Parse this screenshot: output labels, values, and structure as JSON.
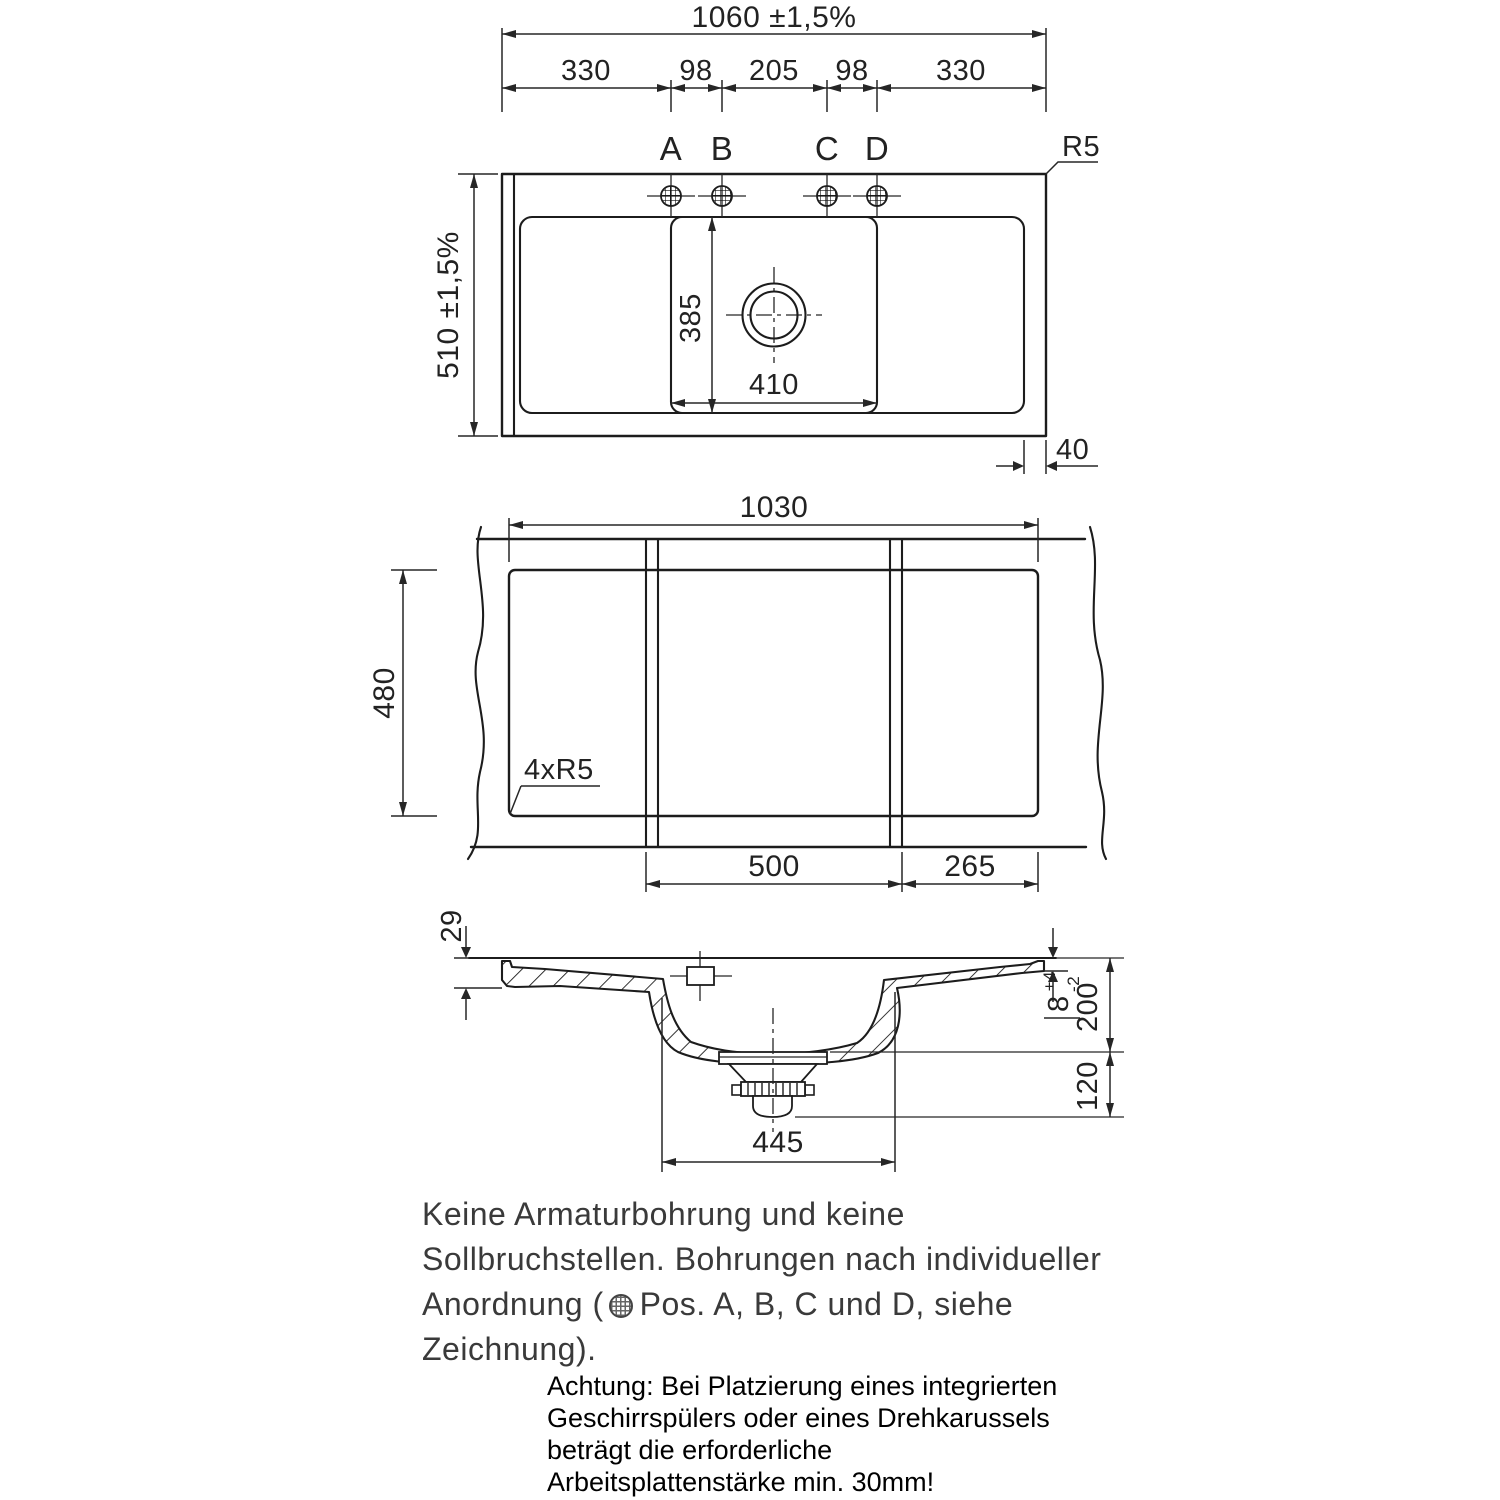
{
  "top_view": {
    "dim_overall_width": "1060 ±1,5%",
    "dim_overall_depth": "510 ±1,5%",
    "dim_seg_330": "330",
    "dim_seg_98": "98",
    "dim_seg_205": "205",
    "dim_bowl_depth": "385",
    "dim_bowl_width": "410",
    "dim_rim_right": "40",
    "label_corner_radius": "R5",
    "hole_labels": [
      "A",
      "B",
      "C",
      "D"
    ]
  },
  "cutout_view": {
    "dim_cutout_width": "1030",
    "dim_cutout_depth": "480",
    "label_corner_radius": "4xR5",
    "dim_seg_bowl": "500",
    "dim_seg_right": "265"
  },
  "section_view": {
    "dim_rim_height": "29",
    "dim_edge_thickness": "8",
    "tol_plus": "+4",
    "tol_minus": "-2",
    "dim_bowl_depth": "200",
    "dim_drain_height": "120",
    "dim_bowl_outer_width": "445"
  },
  "notes": {
    "drilling": {
      "line1": "Keine Armaturbohrung und keine",
      "line2": "Sollbruchstellen. Bohrungen nach individueller",
      "line3_before_symbol": "Anordnung (",
      "line3_after_symbol": "Pos. A, B, C und D, siehe",
      "line4": "Zeichnung)."
    },
    "warning": {
      "line1": "Achtung: Bei Platzierung eines integrierten",
      "line2": "Geschirrspülers oder eines Drehkarussels",
      "line3": "beträgt die erforderliche",
      "line4": "Arbeitsplattenstärke min. 30mm!"
    }
  },
  "colors": {
    "line": "#1c1c1c",
    "dim": "#262626",
    "text": "#222222",
    "background": "#ffffff"
  }
}
